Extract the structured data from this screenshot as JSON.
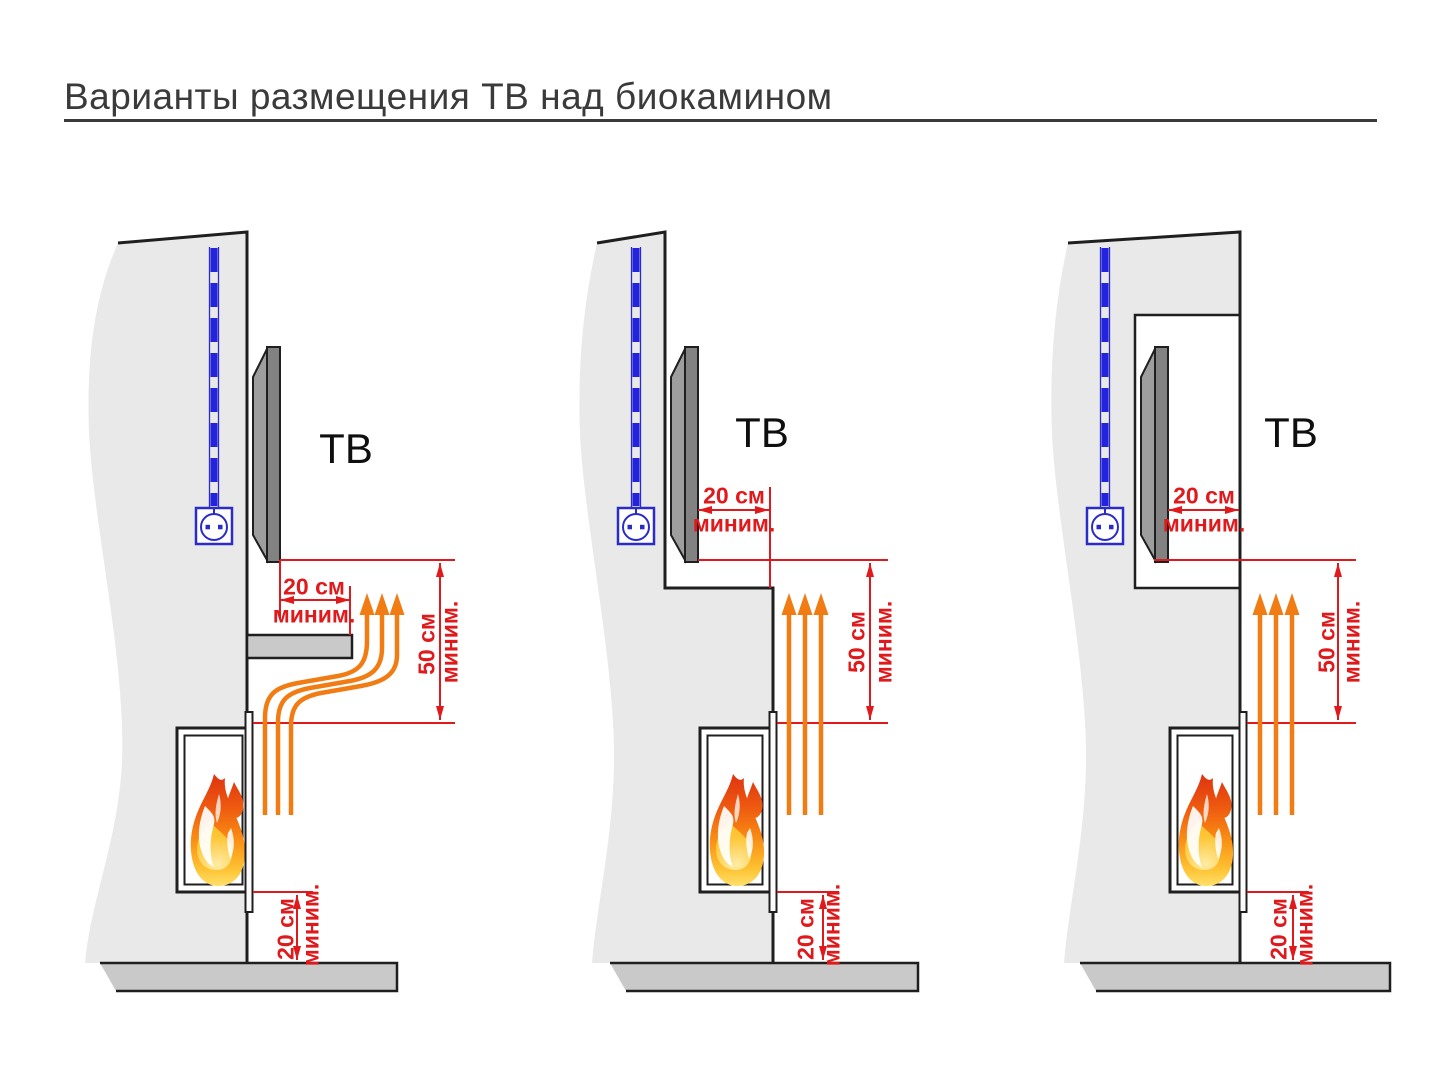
{
  "title": "Варианты размещения ТВ над биокамином",
  "colors": {
    "dimension_red": "#e01a1c",
    "heat_orange": "#f17c14",
    "cable_blue": "#2b2cc7",
    "wall_fill": "#e9e9e9",
    "slab_fill": "#c9c9c9",
    "tv_fill": "#828282",
    "outline": "#1f1f1f",
    "title_text": "#3a3a3a"
  },
  "icons": {
    "power_outlet": "outlet-schematic",
    "power_cable": "dashed-cable-in-conduit",
    "heat_flow": "orange-up-arrows",
    "fire": "flame"
  },
  "diagrams": [
    {
      "tv_label": "ТВ",
      "front_gap": {
        "value": "20 см",
        "qualifier": "миним."
      },
      "above_fire": {
        "value": "50 см",
        "qualifier": "миним."
      },
      "floor_gap": {
        "value": "20 см",
        "qualifier": "миним."
      }
    },
    {
      "tv_label": "ТВ",
      "front_gap": {
        "value": "20 см",
        "qualifier": "миним."
      },
      "above_fire": {
        "value": "50 см",
        "qualifier": "миним."
      },
      "floor_gap": {
        "value": "20 см",
        "qualifier": "миним."
      }
    },
    {
      "tv_label": "ТВ",
      "front_gap": {
        "value": "20 см",
        "qualifier": "миним."
      },
      "above_fire": {
        "value": "50 см",
        "qualifier": "миним."
      },
      "floor_gap": {
        "value": "20 см",
        "qualifier": "миним."
      }
    }
  ]
}
